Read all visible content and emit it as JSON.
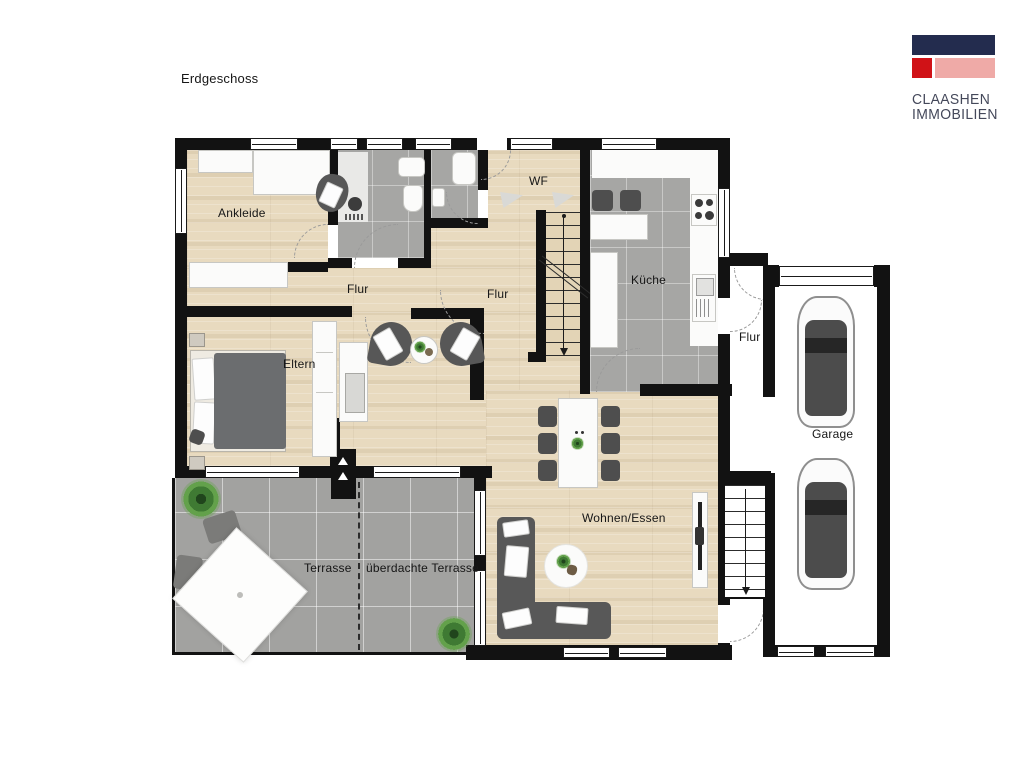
{
  "page": {
    "background": "#ffffff"
  },
  "logo": {
    "line1": "CLAASHEN",
    "line2": "IMMOBILIEN",
    "colors": {
      "navy": "#232c4e",
      "red": "#d01217",
      "pink": "#efaaa7"
    }
  },
  "floorplan": {
    "labels": {
      "floor_title": "Erdgeschoss",
      "ankleide": "Ankleide",
      "flur_upper": "Flur",
      "flur_hall": "Flur",
      "wf": "WF",
      "kueche": "Küche",
      "eltern": "Eltern",
      "wohnen_essen": "Wohnen/Essen",
      "terrasse": "Terrasse",
      "ueberdachte_terrasse": "überdachte Terrasse",
      "flur_garage": "Flur",
      "garage": "Garage"
    },
    "colors": {
      "wall": "#121212",
      "wood_floor": "#e8dabf",
      "tile_floor": "#a6a6a4",
      "terrace_tile": "#a2a2a0",
      "furniture_dark": "#575757",
      "plant_green": "#3f7a33"
    }
  }
}
